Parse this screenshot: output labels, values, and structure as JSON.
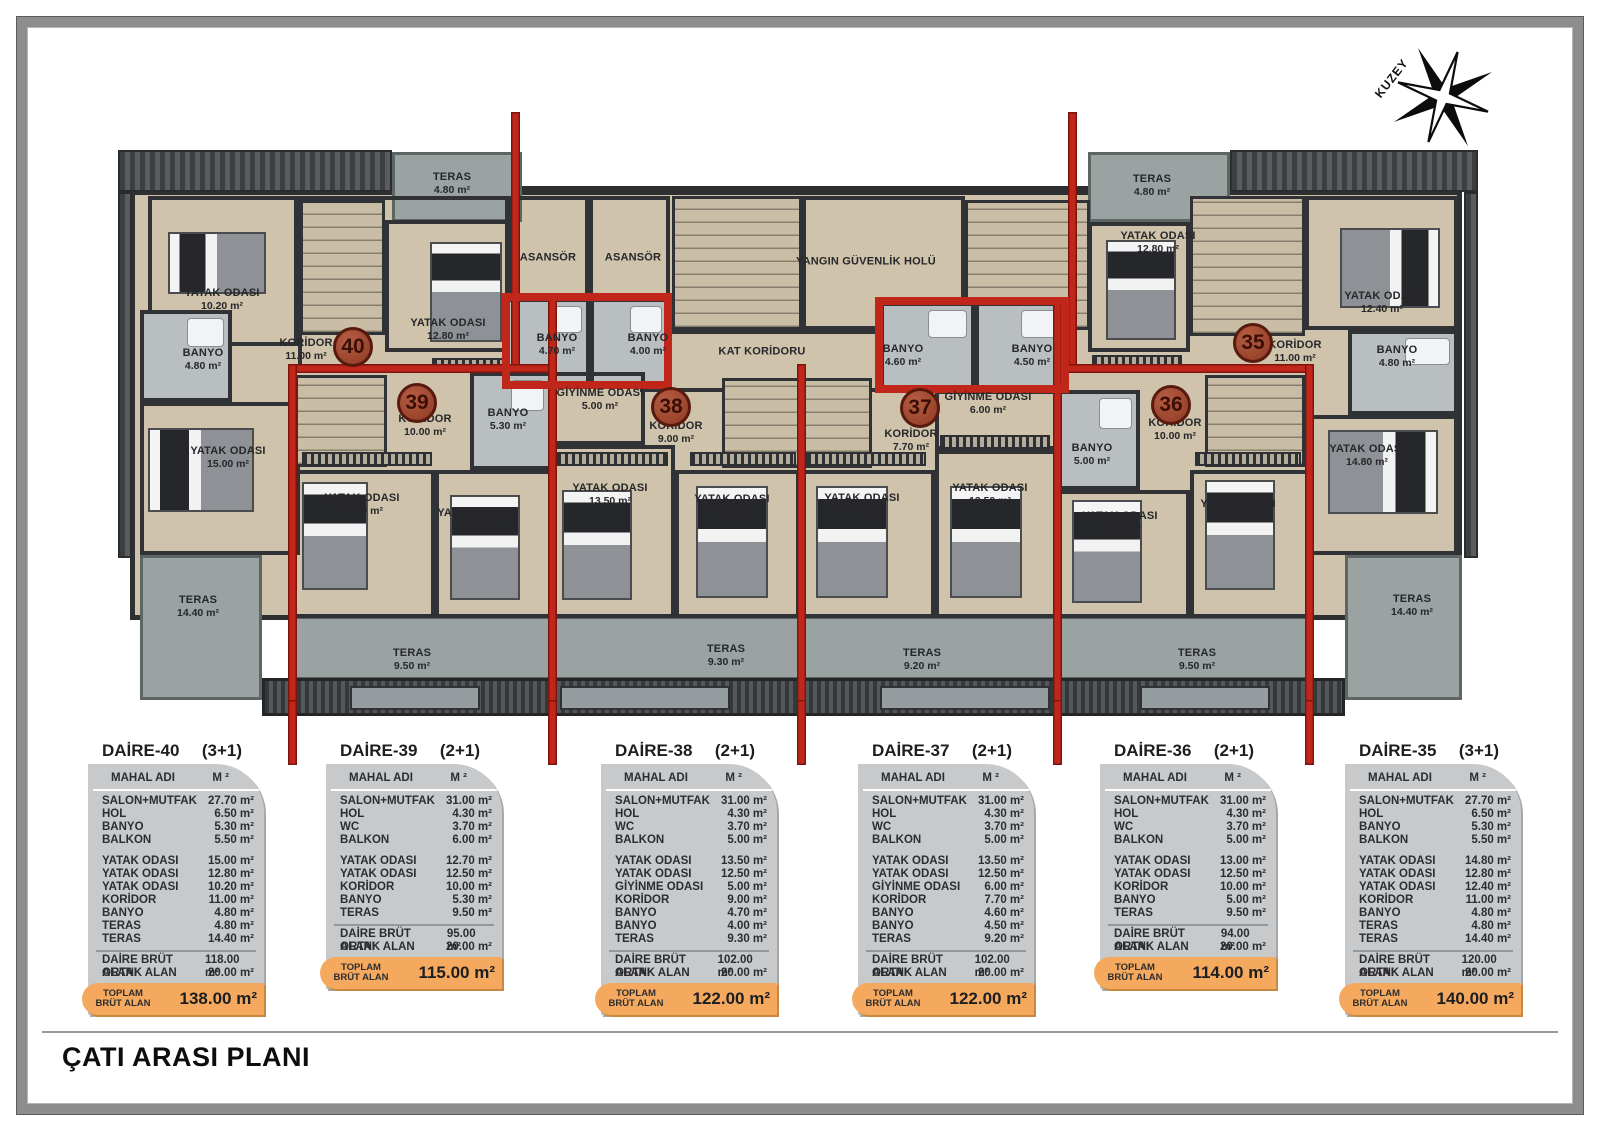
{
  "sheet": {
    "title": "ÇATI ARASI PLANI"
  },
  "compass": {
    "label": "KUZEY"
  },
  "plan": {
    "unit_markers": [
      {
        "number": "40",
        "x": 353,
        "y": 347
      },
      {
        "number": "39",
        "x": 417,
        "y": 403
      },
      {
        "number": "38",
        "x": 671,
        "y": 407
      },
      {
        "number": "37",
        "x": 920,
        "y": 408
      },
      {
        "number": "36",
        "x": 1171,
        "y": 405
      },
      {
        "number": "35",
        "x": 1253,
        "y": 343
      }
    ],
    "labels": [
      {
        "name": "TERAS",
        "area": "4.80 m²",
        "x": 452,
        "y": 184
      },
      {
        "name": "YATAK ODASI",
        "area": "10.20 m²",
        "x": 222,
        "y": 300
      },
      {
        "name": "BANYO",
        "area": "4.80 m²",
        "x": 203,
        "y": 360
      },
      {
        "name": "KORİDOR",
        "area": "11.00 m²",
        "x": 306,
        "y": 350
      },
      {
        "name": "YATAK ODASI",
        "area": "12.80 m²",
        "x": 448,
        "y": 330
      },
      {
        "name": "YATAK ODASI",
        "area": "15.00 m²",
        "x": 228,
        "y": 458
      },
      {
        "name": "TERAS",
        "area": "14.40 m²",
        "x": 198,
        "y": 607
      },
      {
        "name": "KORİDOR",
        "area": "10.00 m²",
        "x": 425,
        "y": 426
      },
      {
        "name": "BANYO",
        "area": "5.30 m²",
        "x": 508,
        "y": 420
      },
      {
        "name": "YATAK ODASI",
        "area": "12.50 m²",
        "x": 362,
        "y": 505
      },
      {
        "name": "YATAK ODASI",
        "area": "12.70 m²",
        "x": 475,
        "y": 520
      },
      {
        "name": "TERAS",
        "area": "9.50 m²",
        "x": 412,
        "y": 660
      },
      {
        "name": "ASANSÖR",
        "area": "",
        "x": 548,
        "y": 258
      },
      {
        "name": "ASANSÖR",
        "area": "",
        "x": 633,
        "y": 258
      },
      {
        "name": "BANYO",
        "area": "4.70 m²",
        "x": 557,
        "y": 345
      },
      {
        "name": "BANYO",
        "area": "4.00 m²",
        "x": 648,
        "y": 345
      },
      {
        "name": "GİYİNME ODASI",
        "area": "5.00 m²",
        "x": 600,
        "y": 400
      },
      {
        "name": "KORİDOR",
        "area": "9.00 m²",
        "x": 676,
        "y": 433
      },
      {
        "name": "YATAK ODASI",
        "area": "13.50 m²",
        "x": 610,
        "y": 495
      },
      {
        "name": "YATAK ODASI",
        "area": "12.50 m²",
        "x": 732,
        "y": 506
      },
      {
        "name": "TERAS",
        "area": "9.30 m²",
        "x": 726,
        "y": 656
      },
      {
        "name": "YANGIN GÜVENLİK HOLÜ",
        "area": "",
        "x": 866,
        "y": 262
      },
      {
        "name": "KAT KORİDORU",
        "area": "",
        "x": 762,
        "y": 352
      },
      {
        "name": "BANYO",
        "area": "4.60 m²",
        "x": 903,
        "y": 356
      },
      {
        "name": "BANYO",
        "area": "4.50 m²",
        "x": 1032,
        "y": 356
      },
      {
        "name": "GİYİNME ODASI",
        "area": "6.00 m²",
        "x": 988,
        "y": 404
      },
      {
        "name": "KORİDOR",
        "area": "7.70 m²",
        "x": 911,
        "y": 441
      },
      {
        "name": "YATAK ODASI",
        "area": "12.50 m²",
        "x": 862,
        "y": 505
      },
      {
        "name": "YATAK ODASI",
        "area": "13.50 m²",
        "x": 990,
        "y": 495
      },
      {
        "name": "TERAS",
        "area": "9.20 m²",
        "x": 922,
        "y": 660
      },
      {
        "name": "BANYO",
        "area": "5.00 m²",
        "x": 1092,
        "y": 455
      },
      {
        "name": "KORİDOR",
        "area": "10.00 m²",
        "x": 1175,
        "y": 430
      },
      {
        "name": "YATAK ODASI",
        "area": "13.00 m²",
        "x": 1120,
        "y": 523
      },
      {
        "name": "YATAK ODASI",
        "area": "12.50 m²",
        "x": 1238,
        "y": 511
      },
      {
        "name": "TERAS",
        "area": "9.50 m²",
        "x": 1197,
        "y": 660
      },
      {
        "name": "TERAS",
        "area": "4.80 m²",
        "x": 1152,
        "y": 186
      },
      {
        "name": "YATAK ODASI",
        "area": "12.80 m²",
        "x": 1158,
        "y": 243
      },
      {
        "name": "YATAK ODASI",
        "area": "12.40 m²",
        "x": 1382,
        "y": 303
      },
      {
        "name": "KORİDOR",
        "area": "11.00 m²",
        "x": 1295,
        "y": 352
      },
      {
        "name": "BANYO",
        "area": "4.80 m²",
        "x": 1397,
        "y": 357
      },
      {
        "name": "YATAK ODASI",
        "area": "14.80 m²",
        "x": 1367,
        "y": 456
      },
      {
        "name": "TERAS",
        "area": "14.40 m²",
        "x": 1412,
        "y": 606
      }
    ]
  },
  "tables_common": {
    "head_col1": "MAHAL ADI",
    "head_col2": "M ²",
    "footer_label": "TOPLAM BRÜT ALAN"
  },
  "tables": [
    {
      "name": "DAİRE-40",
      "type": "(3+1)",
      "x": 88,
      "rows1": [
        [
          "SALON+MUTFAK",
          "27.70 m²"
        ],
        [
          "HOL",
          "6.50 m²"
        ],
        [
          "BANYO",
          "5.30 m²"
        ],
        [
          "BALKON",
          "5.50 m²"
        ]
      ],
      "rows2": [
        [
          "YATAK ODASI",
          "15.00 m²"
        ],
        [
          "YATAK ODASI",
          "12.80 m²"
        ],
        [
          "YATAK ODASI",
          "10.20 m²"
        ],
        [
          "KORİDOR",
          "11.00 m²"
        ],
        [
          "BANYO",
          "4.80 m²"
        ],
        [
          "TERAS",
          "4.80 m²"
        ],
        [
          "TERAS",
          "14.40 m²"
        ]
      ],
      "totals": [
        [
          "DAİRE BRÜT ALANI",
          "118.00 m²"
        ],
        [
          "ORTAK ALAN",
          "20.00 m²"
        ]
      ],
      "footer_value": "138.00 m²"
    },
    {
      "name": "DAİRE-39",
      "type": "(2+1)",
      "x": 326,
      "rows1": [
        [
          "SALON+MUTFAK",
          "31.00 m²"
        ],
        [
          "HOL",
          "4.30 m²"
        ],
        [
          "WC",
          "3.70 m²"
        ],
        [
          "BALKON",
          "6.00 m²"
        ]
      ],
      "rows2": [
        [
          "YATAK ODASI",
          "12.70 m²"
        ],
        [
          "YATAK ODASI",
          "12.50 m²"
        ],
        [
          "KORİDOR",
          "10.00 m²"
        ],
        [
          "BANYO",
          "5.30 m²"
        ],
        [
          "TERAS",
          "9.50 m²"
        ]
      ],
      "totals": [
        [
          "DAİRE BRÜT ALANI",
          "95.00 m²"
        ],
        [
          "ORTAK ALAN",
          "20.00 m²"
        ]
      ],
      "footer_value": "115.00 m²"
    },
    {
      "name": "DAİRE-38",
      "type": "(2+1)",
      "x": 601,
      "rows1": [
        [
          "SALON+MUTFAK",
          "31.00 m²"
        ],
        [
          "HOL",
          "4.30 m²"
        ],
        [
          "WC",
          "3.70 m²"
        ],
        [
          "BALKON",
          "5.00 m²"
        ]
      ],
      "rows2": [
        [
          "YATAK ODASI",
          "13.50 m²"
        ],
        [
          "YATAK ODASI",
          "12.50 m²"
        ],
        [
          "GİYİNME ODASI",
          "5.00 m²"
        ],
        [
          "KORİDOR",
          "9.00 m²"
        ],
        [
          "BANYO",
          "4.70 m²"
        ],
        [
          "BANYO",
          "4.00 m²"
        ],
        [
          "TERAS",
          "9.30 m²"
        ]
      ],
      "totals": [
        [
          "DAİRE BRÜT ALANI",
          "102.00 m²"
        ],
        [
          "ORTAK ALAN",
          "20.00 m²"
        ]
      ],
      "footer_value": "122.00 m²"
    },
    {
      "name": "DAİRE-37",
      "type": "(2+1)",
      "x": 858,
      "rows1": [
        [
          "SALON+MUTFAK",
          "31.00 m²"
        ],
        [
          "HOL",
          "4.30 m²"
        ],
        [
          "WC",
          "3.70 m²"
        ],
        [
          "BALKON",
          "5.00 m²"
        ]
      ],
      "rows2": [
        [
          "YATAK ODASI",
          "13.50 m²"
        ],
        [
          "YATAK ODASI",
          "12.50 m²"
        ],
        [
          "GİYİNME ODASI",
          "6.00 m²"
        ],
        [
          "KORİDOR",
          "7.70 m²"
        ],
        [
          "BANYO",
          "4.60 m²"
        ],
        [
          "BANYO",
          "4.50 m²"
        ],
        [
          "TERAS",
          "9.20 m²"
        ]
      ],
      "totals": [
        [
          "DAİRE BRÜT ALANI",
          "102.00 m²"
        ],
        [
          "ORTAK ALAN",
          "20.00 m²"
        ]
      ],
      "footer_value": "122.00 m²"
    },
    {
      "name": "DAİRE-36",
      "type": "(2+1)",
      "x": 1100,
      "rows1": [
        [
          "SALON+MUTFAK",
          "31.00 m²"
        ],
        [
          "HOL",
          "4.30 m²"
        ],
        [
          "WC",
          "3.70 m²"
        ],
        [
          "BALKON",
          "5.00 m²"
        ]
      ],
      "rows2": [
        [
          "YATAK ODASI",
          "13.00 m²"
        ],
        [
          "YATAK ODASI",
          "12.50 m²"
        ],
        [
          "KORİDOR",
          "10.00 m²"
        ],
        [
          "BANYO",
          "5.00 m²"
        ],
        [
          "TERAS",
          "9.50 m²"
        ]
      ],
      "totals": [
        [
          "DAİRE BRÜT ALANI",
          "94.00 m²"
        ],
        [
          "ORTAK ALAN",
          "20.00 m²"
        ]
      ],
      "footer_value": "114.00 m²"
    },
    {
      "name": "DAİRE-35",
      "type": "(3+1)",
      "x": 1345,
      "rows1": [
        [
          "SALON+MUTFAK",
          "27.70 m²"
        ],
        [
          "HOL",
          "6.50 m²"
        ],
        [
          "BANYO",
          "5.30 m²"
        ],
        [
          "BALKON",
          "5.50 m²"
        ]
      ],
      "rows2": [
        [
          "YATAK ODASI",
          "14.80 m²"
        ],
        [
          "YATAK ODASI",
          "12.80 m²"
        ],
        [
          "YATAK ODASI",
          "12.40 m²"
        ],
        [
          "KORİDOR",
          "11.00 m²"
        ],
        [
          "BANYO",
          "4.80 m²"
        ],
        [
          "TERAS",
          "4.80 m²"
        ],
        [
          "TERAS",
          "14.40 m²"
        ]
      ],
      "totals": [
        [
          "DAİRE BRÜT ALANI",
          "120.00 m²"
        ],
        [
          "ORTAK ALAN",
          "20.00 m²"
        ]
      ],
      "footer_value": "140.00 m²"
    }
  ]
}
